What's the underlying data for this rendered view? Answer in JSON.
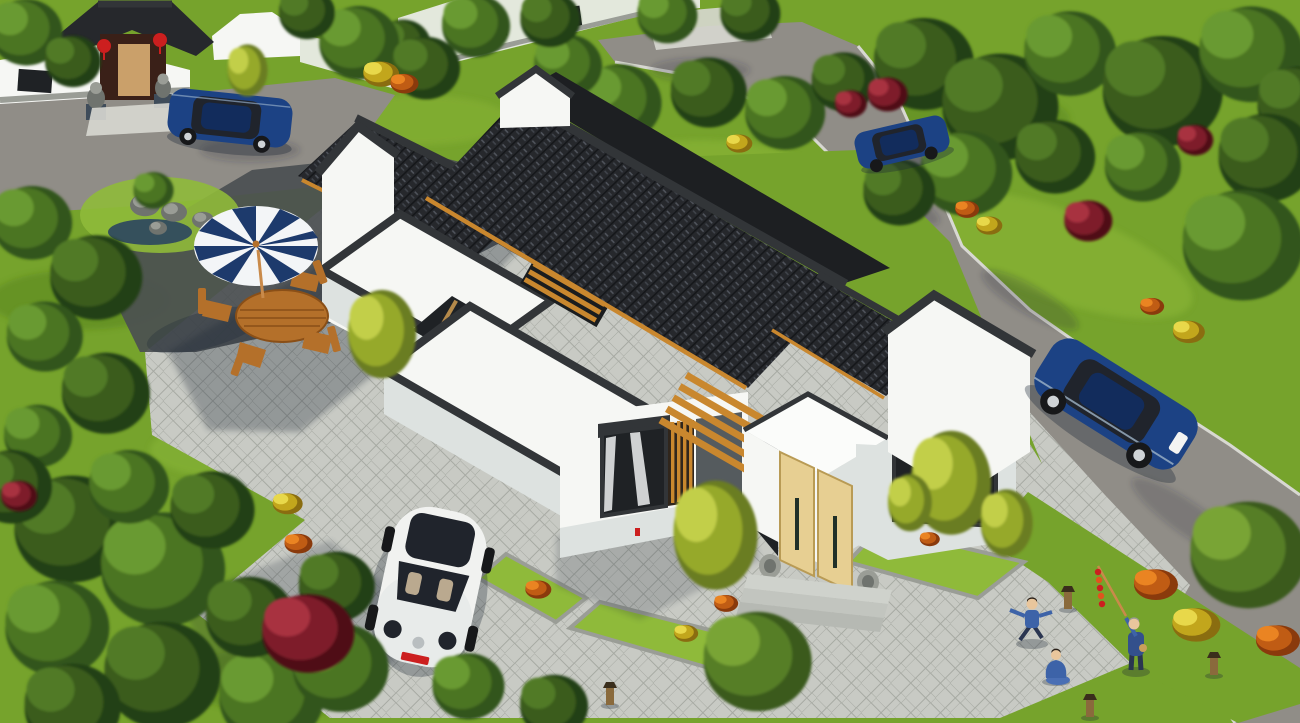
{
  "scene": {
    "type": "3d-architectural-rendering",
    "description": "Aerial 3D rendering of a modern Chinese courtyard house with dark grey tiled gable roofs, white walls, flat white roof terraces, orange wood pergolas and a light-wood entrance door, surrounded by a grey paved plaza, lawns, trees, flowering shrubs, a traditional gate compound, parked cars and people on the plaza",
    "buildings": {
      "main_house": {
        "walls": "white render",
        "roofs": "dark grey Chinese clay tiles with black ridge caps and orange timber eave strips",
        "features": [
          "flat white roof terraces with dark parapets",
          "inner courtyard with timber slat screen",
          "orange timber pergola over entrance",
          "light wood double entrance door with stone drum pair",
          "large window with white curtains and timber slat shutter",
          "stepped horse-head gable walls"
        ]
      },
      "gate_compound": {
        "position": "top-left",
        "features": [
          "grey tiled gate roof",
          "dark timber doorway",
          "two red lanterns",
          "two stone lions on pedestals",
          "white perimeter wall with lattice window",
          "cloud-top white wall",
          "rock garden with small pond"
        ]
      },
      "neighbour_house": {
        "position": "top-middle",
        "features": [
          "pale wall with lattice windows",
          "entrance flanked by two stone lions",
          "stone steps"
        ]
      }
    },
    "vehicles": [
      {
        "type": "sedan",
        "color": "blue",
        "location": "parked in front of gate, top-left"
      },
      {
        "type": "sedan",
        "color": "blue",
        "location": "on road, top-middle-right"
      },
      {
        "type": "sedan",
        "color": "blue",
        "location": "on road, right side"
      },
      {
        "type": "beetle hatchback",
        "color": "white",
        "location": "parked on plaza in front of house",
        "details": "black panoramic sunroof, red front plate"
      }
    ],
    "people": [
      {
        "pose": "child running with arms out",
        "clothing": "blue"
      },
      {
        "pose": "person sitting on paving",
        "clothing": "blue"
      },
      {
        "pose": "elder standing holding a pole with red kite tail",
        "clothing": "blue"
      }
    ],
    "furniture": {
      "umbrella": "navy and white striped parasol",
      "table": "oval wooden table",
      "chairs": 4
    },
    "landscape": [
      "lawns",
      "deciduous trees",
      "weeping willows",
      "bamboo clumps",
      "red and crimson shrubs",
      "yellow and orange flower beds",
      "stone-edged planting beds",
      "timber bollard lamps",
      "grey block paving in herringbone pattern",
      "asphalt roads with light curbs"
    ]
  },
  "palette": {
    "grass": "#76a32c",
    "grassLight": "#8fba3a",
    "grassDark": "#4e7a1d",
    "road": "#908d87",
    "asphalt": "#4b4f51",
    "curb": "#d8d8d2",
    "paveLight": "#c8cac4",
    "paveLine": "#a7aaa3",
    "wallWhite": "#f6f7f4",
    "wallShade": "#dde2e0",
    "wallGreen": "#e3e8dc",
    "trim": "#323538",
    "tileDark": "#26282c",
    "tileLine": "#15171a",
    "tileLight": "#565b63",
    "woodOrange": "#c9872e",
    "doorWood": "#e7cf92",
    "glass": "#1f2225",
    "curtain": "#eef0f1",
    "stone": "#9a9d96",
    "stoneDark": "#6f736e",
    "water": "#35505c",
    "umbNavy": "#1d3a6c",
    "umbWhite": "#f3f5f7",
    "furnWood": "#b4702a",
    "carBlue": "#1c4284",
    "carBlueDark": "#122c5c",
    "carWhite": "#f1f2f0",
    "carGlass": "#20242c",
    "wheel": "#17181a",
    "skin": "#e9c69c",
    "clothBlue": "#3d63a8",
    "clothDark": "#2a3550",
    "lanternRed": "#cc1f1f",
    "kiteOrange": "#e0551e",
    "shadow": "#1d2836",
    "poleWood": "#c98a4a"
  },
  "vegetation": {
    "tones": {
      "dark": [
        "#243f13",
        "#3a5c1c",
        "#517a26"
      ],
      "mid": [
        "#32541a",
        "#4c7424",
        "#699a30"
      ],
      "light": [
        "#3f6a1f",
        "#5f8c2a",
        "#82ae39"
      ],
      "willow": [
        "#3a5a1e",
        "#567e28",
        "#79a435"
      ],
      "bamboo": [
        "#6b7d20",
        "#96a92c",
        "#c2cf4a"
      ],
      "red": [
        "#4f1118",
        "#7e1f2a",
        "#a83240"
      ],
      "yellow": [
        "#8a6d10",
        "#c2a61c",
        "#e8d84a"
      ],
      "orange": [
        "#8a3a0c",
        "#c05c14",
        "#ea8422"
      ]
    },
    "trees_back": [
      [
        915,
        58,
        50,
        "dark"
      ],
      [
        990,
        100,
        58,
        "dark"
      ],
      [
        1062,
        48,
        46,
        "mid"
      ],
      [
        1152,
        84,
        60,
        "dark"
      ],
      [
        1242,
        48,
        52,
        "mid"
      ],
      [
        1292,
        100,
        42,
        "dark"
      ],
      [
        958,
        168,
        46,
        "mid"
      ],
      [
        1048,
        152,
        40,
        "dark"
      ],
      [
        1136,
        162,
        38,
        "mid"
      ],
      [
        1258,
        152,
        48,
        "dark"
      ],
      [
        1232,
        238,
        60,
        "mid"
      ],
      [
        893,
        188,
        36,
        "dark"
      ],
      [
        612,
        98,
        42,
        "mid"
      ],
      [
        702,
        88,
        38,
        "dark"
      ],
      [
        778,
        108,
        40,
        "mid"
      ],
      [
        838,
        78,
        32,
        "dark"
      ],
      [
        562,
        62,
        34,
        "mid"
      ],
      [
        470,
        22,
        34,
        "mid"
      ],
      [
        545,
        16,
        30,
        "dark"
      ],
      [
        662,
        12,
        30,
        "mid"
      ],
      [
        745,
        10,
        30,
        "dark"
      ],
      [
        398,
        42,
        28,
        "dark"
      ],
      [
        352,
        38,
        40,
        "mid"
      ],
      [
        420,
        64,
        34,
        "dark"
      ],
      [
        302,
        10,
        28,
        "dark"
      ],
      [
        20,
        28,
        36,
        "mid"
      ],
      [
        68,
        58,
        28,
        "dark"
      ],
      [
        25,
        218,
        40,
        "mid"
      ],
      [
        88,
        272,
        46,
        "dark"
      ],
      [
        38,
        332,
        38,
        "mid"
      ],
      [
        98,
        388,
        44,
        "dark"
      ],
      [
        32,
        432,
        34,
        "mid"
      ],
      [
        150,
        188,
        20,
        "mid"
      ]
    ],
    "trees_front": [
      [
        62,
        522,
        58,
        "dark"
      ],
      [
        152,
        562,
        62,
        "mid"
      ],
      [
        48,
        622,
        52,
        "mid"
      ],
      [
        152,
        668,
        58,
        "dark"
      ],
      [
        262,
        692,
        52,
        "mid"
      ],
      [
        64,
        702,
        48,
        "dark"
      ],
      [
        242,
        612,
        44,
        "dark"
      ],
      [
        332,
        662,
        48,
        "mid"
      ],
      [
        122,
        482,
        40,
        "mid"
      ],
      [
        205,
        505,
        42,
        "dark"
      ],
      [
        5,
        482,
        40,
        "dark"
      ],
      [
        330,
        582,
        38,
        "dark"
      ],
      [
        462,
        682,
        36,
        "mid"
      ],
      [
        548,
        702,
        34,
        "dark"
      ],
      [
        748,
        655,
        54,
        "willow"
      ],
      [
        1238,
        548,
        58,
        "willow"
      ]
    ],
    "bushes": [
      [
        300,
        628,
        46,
        "red"
      ],
      [
        884,
        92,
        20,
        "red"
      ],
      [
        1192,
        138,
        18,
        "red"
      ],
      [
        1084,
        218,
        24,
        "red"
      ],
      [
        16,
        494,
        18,
        "red"
      ],
      [
        848,
        102,
        16,
        "red"
      ],
      [
        376,
        330,
        34,
        "bamboo"
      ],
      [
        708,
        530,
        42,
        "bamboo"
      ],
      [
        944,
        478,
        40,
        "bamboo"
      ],
      [
        1002,
        520,
        26,
        "bamboo"
      ],
      [
        244,
        68,
        20,
        "bamboo"
      ],
      [
        906,
        500,
        22,
        "bamboo"
      ]
    ],
    "flowers": [
      [
        285,
        502,
        15,
        "yellow"
      ],
      [
        737,
        142,
        13,
        "yellow"
      ],
      [
        987,
        224,
        13,
        "yellow"
      ],
      [
        1186,
        330,
        16,
        "yellow"
      ],
      [
        1192,
        622,
        24,
        "yellow"
      ],
      [
        378,
        72,
        18,
        "yellow"
      ],
      [
        684,
        632,
        12,
        "yellow"
      ],
      [
        296,
        542,
        14,
        "orange"
      ],
      [
        965,
        208,
        12,
        "orange"
      ],
      [
        1150,
        305,
        12,
        "orange"
      ],
      [
        1152,
        582,
        22,
        "orange"
      ],
      [
        1274,
        638,
        22,
        "orange"
      ],
      [
        402,
        82,
        14,
        "orange"
      ],
      [
        536,
        588,
        13,
        "orange"
      ],
      [
        724,
        602,
        12,
        "orange"
      ],
      [
        928,
        538,
        10,
        "orange"
      ]
    ],
    "lamps": [
      [
        1068,
        592
      ],
      [
        1214,
        658
      ],
      [
        1090,
        700
      ],
      [
        610,
        688
      ]
    ],
    "rocks": [
      [
        145,
        205,
        15
      ],
      [
        174,
        212,
        13
      ],
      [
        203,
        220,
        11
      ],
      [
        158,
        228,
        9
      ],
      [
        955,
        548,
        9
      ]
    ]
  }
}
